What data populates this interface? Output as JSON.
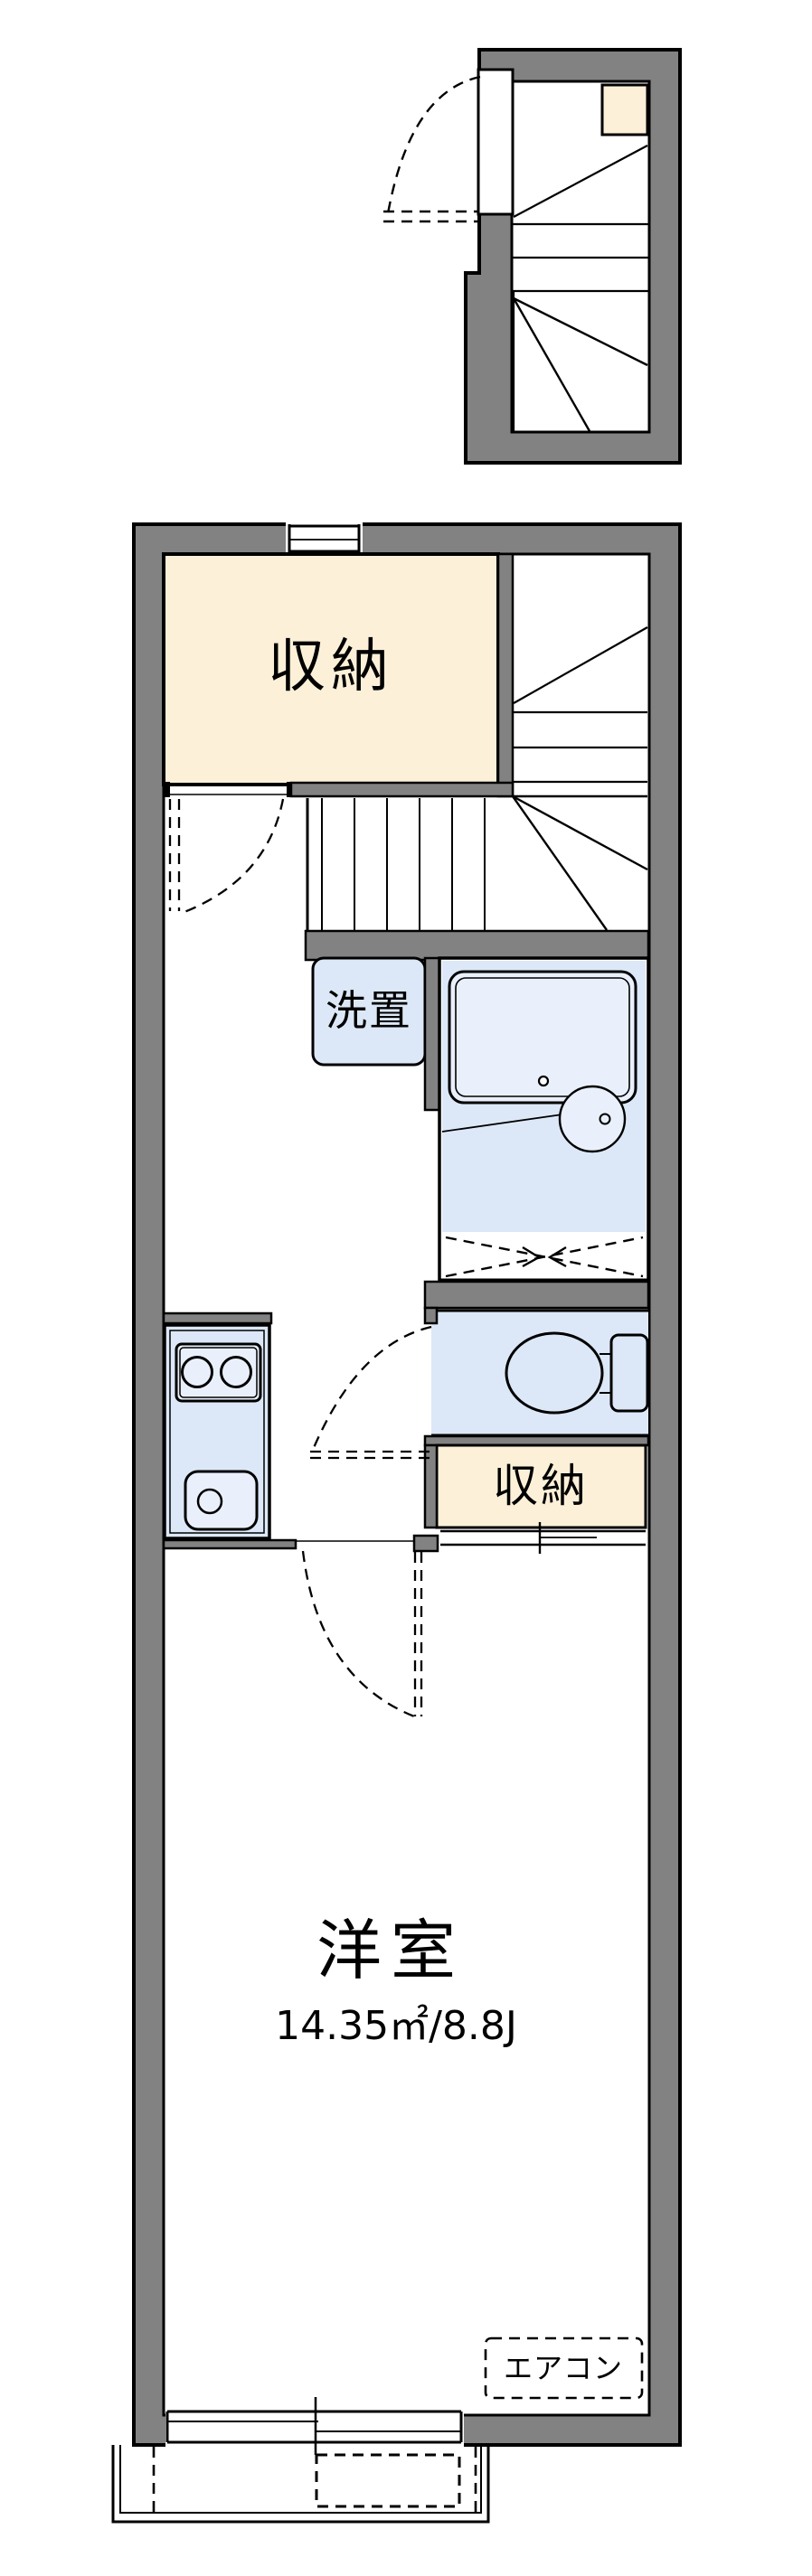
{
  "title": "1K apartment floor plan",
  "colors": {
    "wall_gray": "#828282",
    "line_black": "#000000",
    "storage_cream": "#FCF0D8",
    "fixture_blue": "#DCE8F7",
    "fixture_blue_light": "#E9F0FB",
    "background": "#FFFFFF"
  },
  "rooms": {
    "storage_top": {
      "label": "収納"
    },
    "laundry": {
      "label": "洗置"
    },
    "storage_mid": {
      "label": "収納"
    },
    "main_room": {
      "label": "洋室",
      "area": "14.35㎡/8.8J"
    },
    "aircon": {
      "label": "エアコン"
    }
  }
}
